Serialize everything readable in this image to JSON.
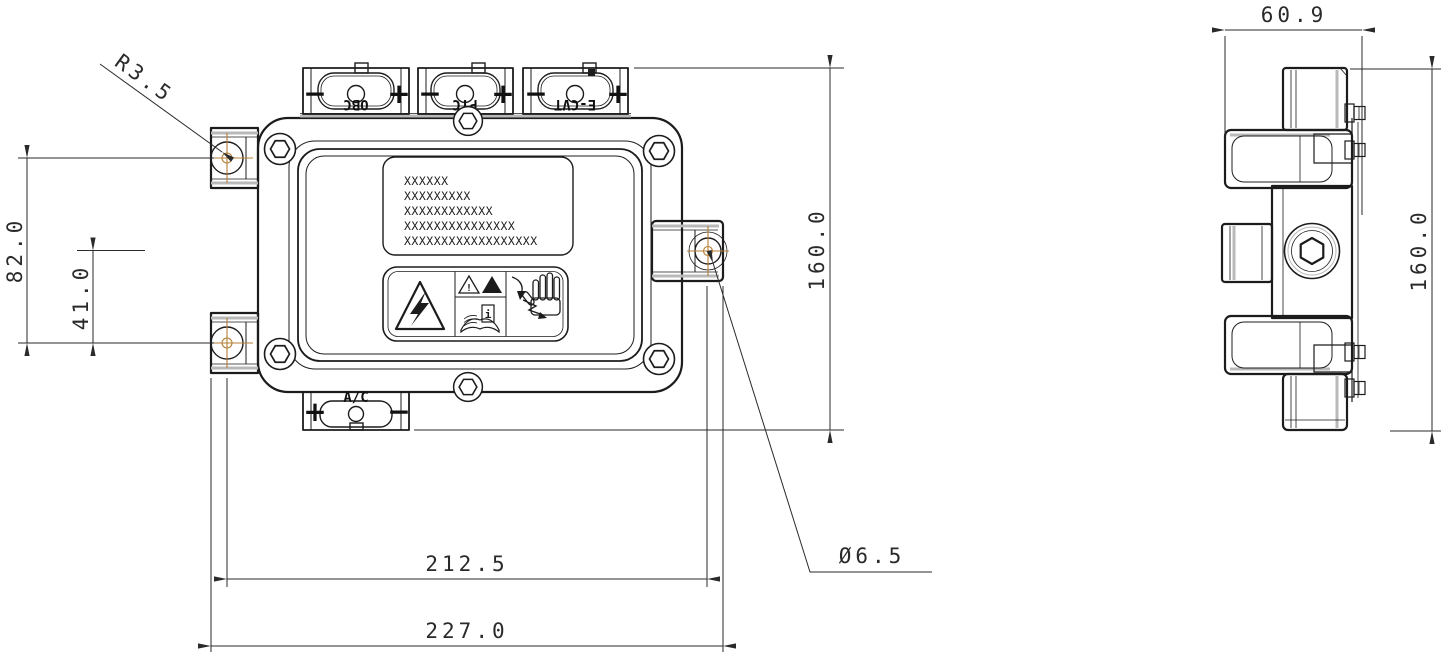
{
  "front_view": {
    "connectors_top": [
      {
        "label": "OBC",
        "minus": "−",
        "plus": "+"
      },
      {
        "label": "PTC",
        "minus": "−",
        "plus": "+"
      },
      {
        "label": "E-CVT",
        "minus": "−",
        "plus": "+"
      }
    ],
    "connector_bottom": {
      "label": "A/C",
      "plus": "+",
      "minus": "−"
    },
    "nameplate_lines": [
      "XXXXXX",
      "XXXXXXXXX",
      "XXXXXXXXXXXX",
      "XXXXXXXXXXXXXXX",
      "XXXXXXXXXXXXXXXXXX"
    ],
    "warning_label": {
      "icons": [
        "high-voltage-triangle",
        "warning-triangle",
        "warning-triangle-filled",
        "read-manual",
        "hand-shock-hazard"
      ],
      "triangle1_mark": "!",
      "triangle2_mark": "!",
      "manual_mark": "i"
    }
  },
  "dimensions": {
    "corner_radius": "R3.5",
    "mount_hole_span_v": "82.0",
    "mount_hole_half_span_v": "41.0",
    "front_height": "160.0",
    "mount_hole_span_h": "212.5",
    "overall_width": "227.0",
    "mount_hole_diameter": "Ø6.5",
    "side_width": "60.9",
    "side_height": "160.0"
  },
  "colors": {
    "line": "#1c1c1c",
    "dimension": "#2a2a2a",
    "centerline": "#b57f35",
    "background": "#ffffff"
  }
}
